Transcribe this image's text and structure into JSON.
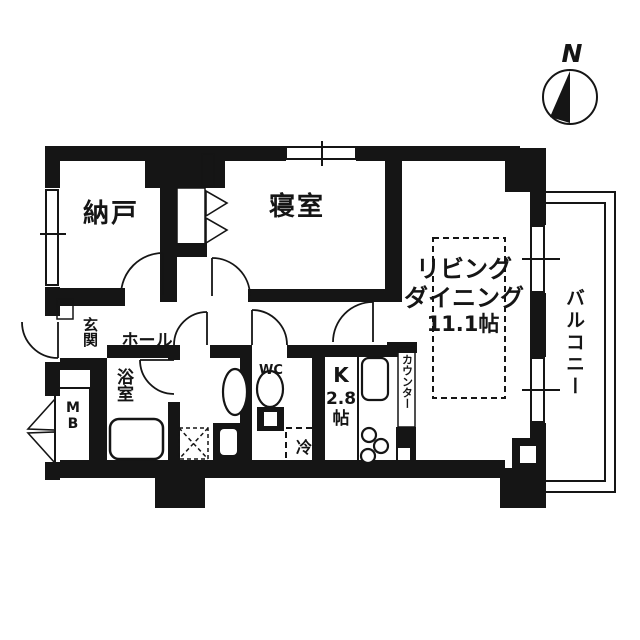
{
  "compass": {
    "north_label": "N"
  },
  "labels": {
    "storage": "納戸",
    "bedroom": "寝室",
    "living_line1": "リビング",
    "living_line2": "ダイニング",
    "living_line3": "11.1帖",
    "balcony": "バルコニー",
    "entrance": "玄関",
    "hall": "ホール",
    "bathroom": "浴室",
    "wc": "WC",
    "kitchen_line1": "K",
    "kitchen_line2": "2.8",
    "kitchen_line3": "帖",
    "counter": "カウンター",
    "fridge": "冷",
    "meter_box": "MB"
  },
  "colors": {
    "wall": "#151515",
    "background": "#ffffff"
  }
}
